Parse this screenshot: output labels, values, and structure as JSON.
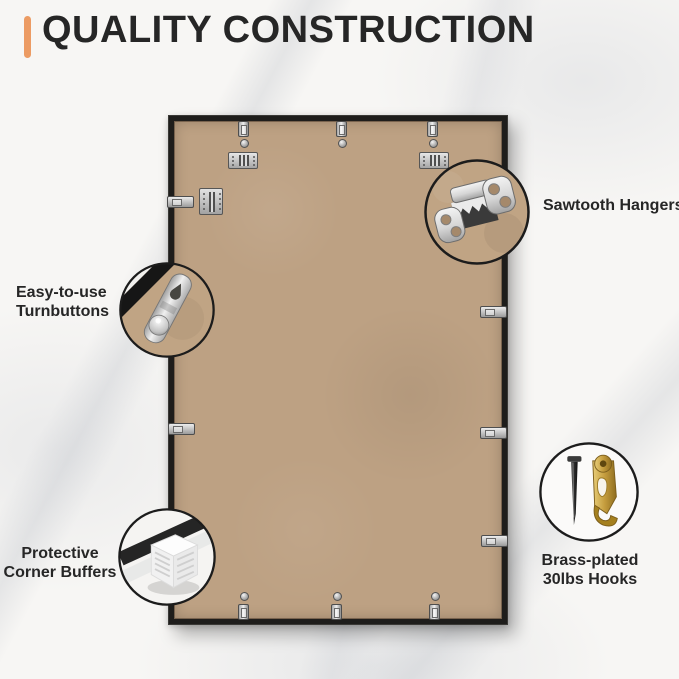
{
  "title": "QUALITY CONSTRUCTION",
  "colors": {
    "accent": "#EC9B63",
    "frame": "#1E1D1B",
    "kraft": "#BDA183",
    "text_dark": "#262626",
    "metal": "#C9C9C9",
    "brass": "#C29A3E"
  },
  "callouts": {
    "sawtooth": {
      "label": "Sawtooth Hangers",
      "icon": "sawtooth-hanger-icon"
    },
    "turnbuttons": {
      "line1": "Easy-to-use",
      "line2": "Turnbuttons",
      "icon": "turnbutton-icon"
    },
    "buffers": {
      "line1": "Protective",
      "line2": "Corner Buffers",
      "icon": "corner-buffer-icon"
    },
    "hooks": {
      "line1": "Brass-plated",
      "line2": "30lbs Hooks",
      "icon": "brass-hook-icon"
    }
  }
}
